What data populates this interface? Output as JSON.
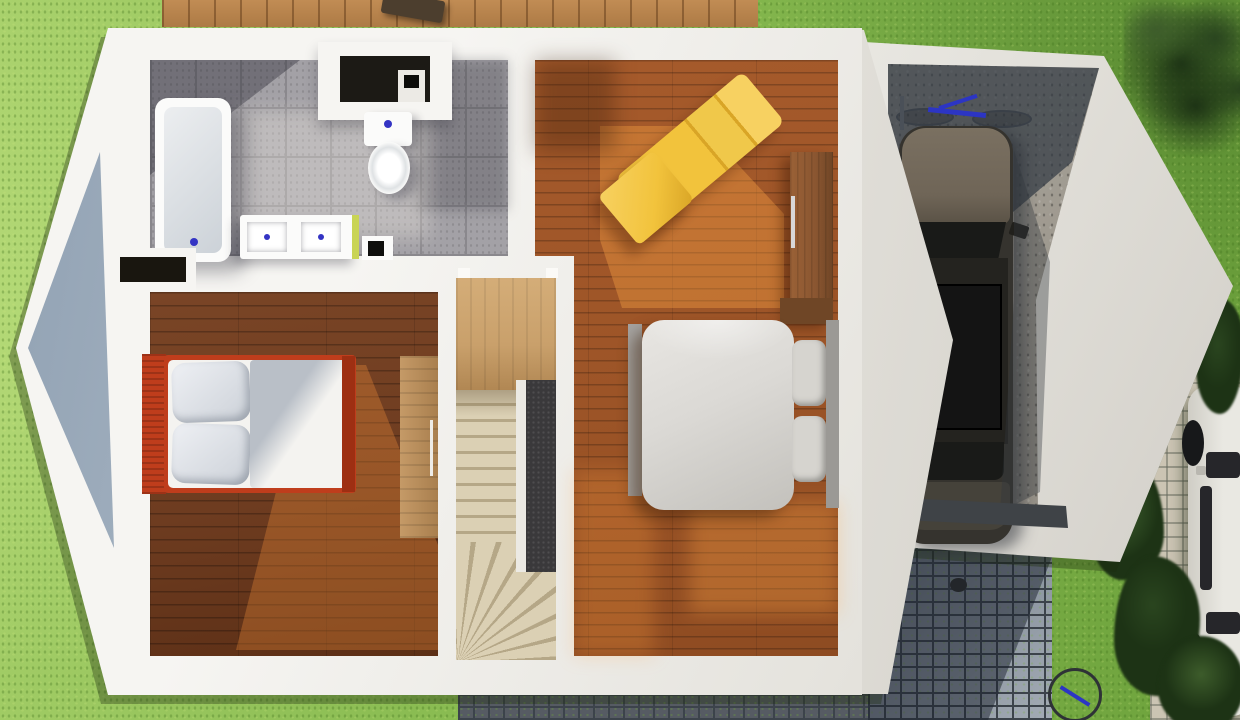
{
  "scene": {
    "description": "3D rendered top-down architectural floor plan of an upper storey with attached single-car garage",
    "view": "top-down 3D render, no text or UI controls visible",
    "environment": [
      "lawn",
      "wood deck along top edge",
      "cobblestone driveway",
      "garden path",
      "hedges",
      "parked white car at right edge",
      "bicycle on lawn at bottom right"
    ]
  },
  "rooms": {
    "bathroom": {
      "floor": "gray ceramic tile",
      "fixtures": [
        "bathtub",
        "toilet with cistern alcove",
        "double-sink vanity with lime accent edge",
        "small utility box"
      ]
    },
    "bedroom_left": {
      "floor": "dark hardwood planks",
      "furniture": [
        "double bed with red-orange frame, gray pillows, white duvet",
        "wood desk with metal handle"
      ],
      "features": [
        "wall closet nook"
      ]
    },
    "stairwell": {
      "features": [
        "upper landing in light wood",
        "straight flight of treads",
        "winder treads fanning at bottom",
        "dark railing panel"
      ]
    },
    "bedroom_right": {
      "floor": "medium hardwood planks with sunlight patches",
      "furniture": [
        "yellow chaise lounge (angled)",
        "yellow ottoman",
        "wood wardrobe with silver handle",
        "double bed with gray frame, gray mattress and pillows"
      ]
    },
    "garage": {
      "floor": "concrete, upper half in shadow",
      "contents": [
        "dark car parked facing in",
        "blue bicycle lying near back wall"
      ],
      "door": "open to cobblestone driveway with dark threshold strip"
    }
  },
  "exterior": {
    "deck": {
      "position": "top edge",
      "object": "dark planter/grill box"
    },
    "driveway": {
      "material": "blue-gray cobblestone, partially in building shadow",
      "detail": "small dark drain dot"
    },
    "bottom_strip": {
      "material": "dark pavers below house"
    },
    "garden_path": {
      "material": "light beige pavers",
      "position": "far right"
    },
    "parked_car": {
      "color": "white",
      "position": "right edge, partially cropped"
    },
    "hedges": [
      "dense trees top-right corner",
      "bush row along right side"
    ],
    "bicycle_outside": {
      "position": "bottom right, wheel partially visible"
    }
  },
  "colors": {
    "grass": "#8abc52",
    "grass-dark": "#6da23c",
    "grass-light": "#a7d06a",
    "deck-wood": "#c18c54",
    "deck-object": "#4c3e2e",
    "wall-light": "#f6f5f2",
    "wall-mid": "#e4e2dc",
    "wall-dark": "#cfccc5",
    "gable-light": "#d3dae1",
    "gable-dark": "#8fa0b2",
    "tile": "#a3a1a6",
    "tile-joint": "#8a888d",
    "tub-basin": "#ccd2d8",
    "fixture-white": "#fbfbfa",
    "drain-blue": "#3434c4",
    "vanity-accent": "#c9d455",
    "wood-dark": "#6e3c20",
    "wood-sun": "#c97a3c",
    "wood-mid": "#9c5427",
    "wood-light": "#c59a67",
    "landing-wood": "#c9a06b",
    "stair-tread": "#dbd0b4",
    "stair-riser": "#b5a787",
    "panel-dark": "#3a393b",
    "bed-red": "#bf3d1c",
    "bed-red-dark": "#9e2f12",
    "pillow-gray": "#ccd1d8",
    "duvet-white": "#f4f3f0",
    "duvet-shadow": "#b9bfc7",
    "bed-gray-frame": "#a5a3a0",
    "mattress-gray": "#dbd9d5",
    "pillow-gray2": "#d6d4cf",
    "yellow": "#f2c33c",
    "yellow-dark": "#d9a526",
    "yellow-light": "#f7d161",
    "wardrobe-wood": "#8a5631",
    "wardrobe-dark": "#6f4626",
    "handle-silver": "#d8d8d8",
    "concrete": "#a39e94",
    "concrete-dark": "#8b867d",
    "car-hood": "#6f6557",
    "car-body": "#35332e",
    "car-glass": "#191a18",
    "car-trunk": "#45423a",
    "bike-blue": "#2c35c4",
    "wheel-dark": "#3a4048",
    "cobble": "#8f98a2",
    "cobble-joint": "#3c434b",
    "cobble-strip": "#565b63",
    "path-paver": "#cbc4b3",
    "bush": "#2a451f",
    "bush-dark": "#1d3315",
    "bush-light": "#3d5c2b",
    "white-car": "#e9e8e2",
    "white-car-glass": "#26262a",
    "threshold": "#3f4347"
  }
}
